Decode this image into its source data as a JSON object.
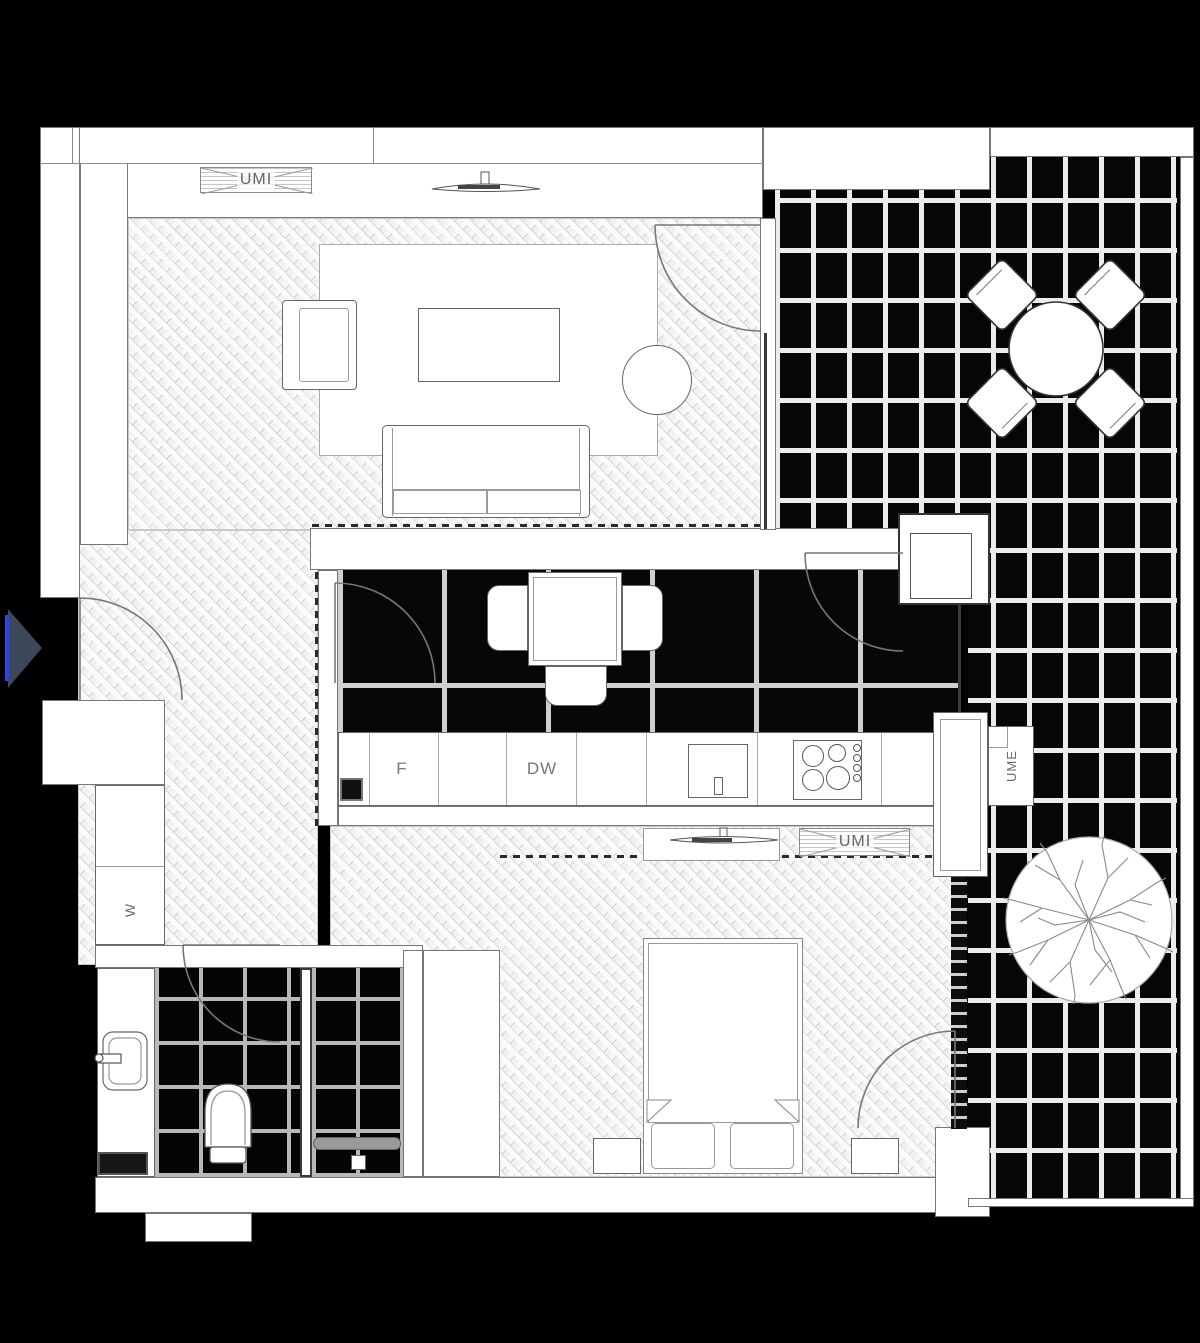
{
  "title": "apartment-floor-plan",
  "labels": {
    "vent_living": "UMI",
    "vent_kitchen": "UMI",
    "vent_utility": "UME",
    "fridge": "F",
    "dishwasher": "DW",
    "washer": "W"
  },
  "palette": {
    "background": "#000000",
    "wall": "#ffffff",
    "outline": "#666666",
    "wood_floor": "#f1f1f1",
    "tile_dark": "#060606",
    "grout": "#ececec",
    "entry_arrow_fill": "#3c4757",
    "entry_arrow_accent": "#2547f0",
    "label_text": "#6a6a6a"
  }
}
